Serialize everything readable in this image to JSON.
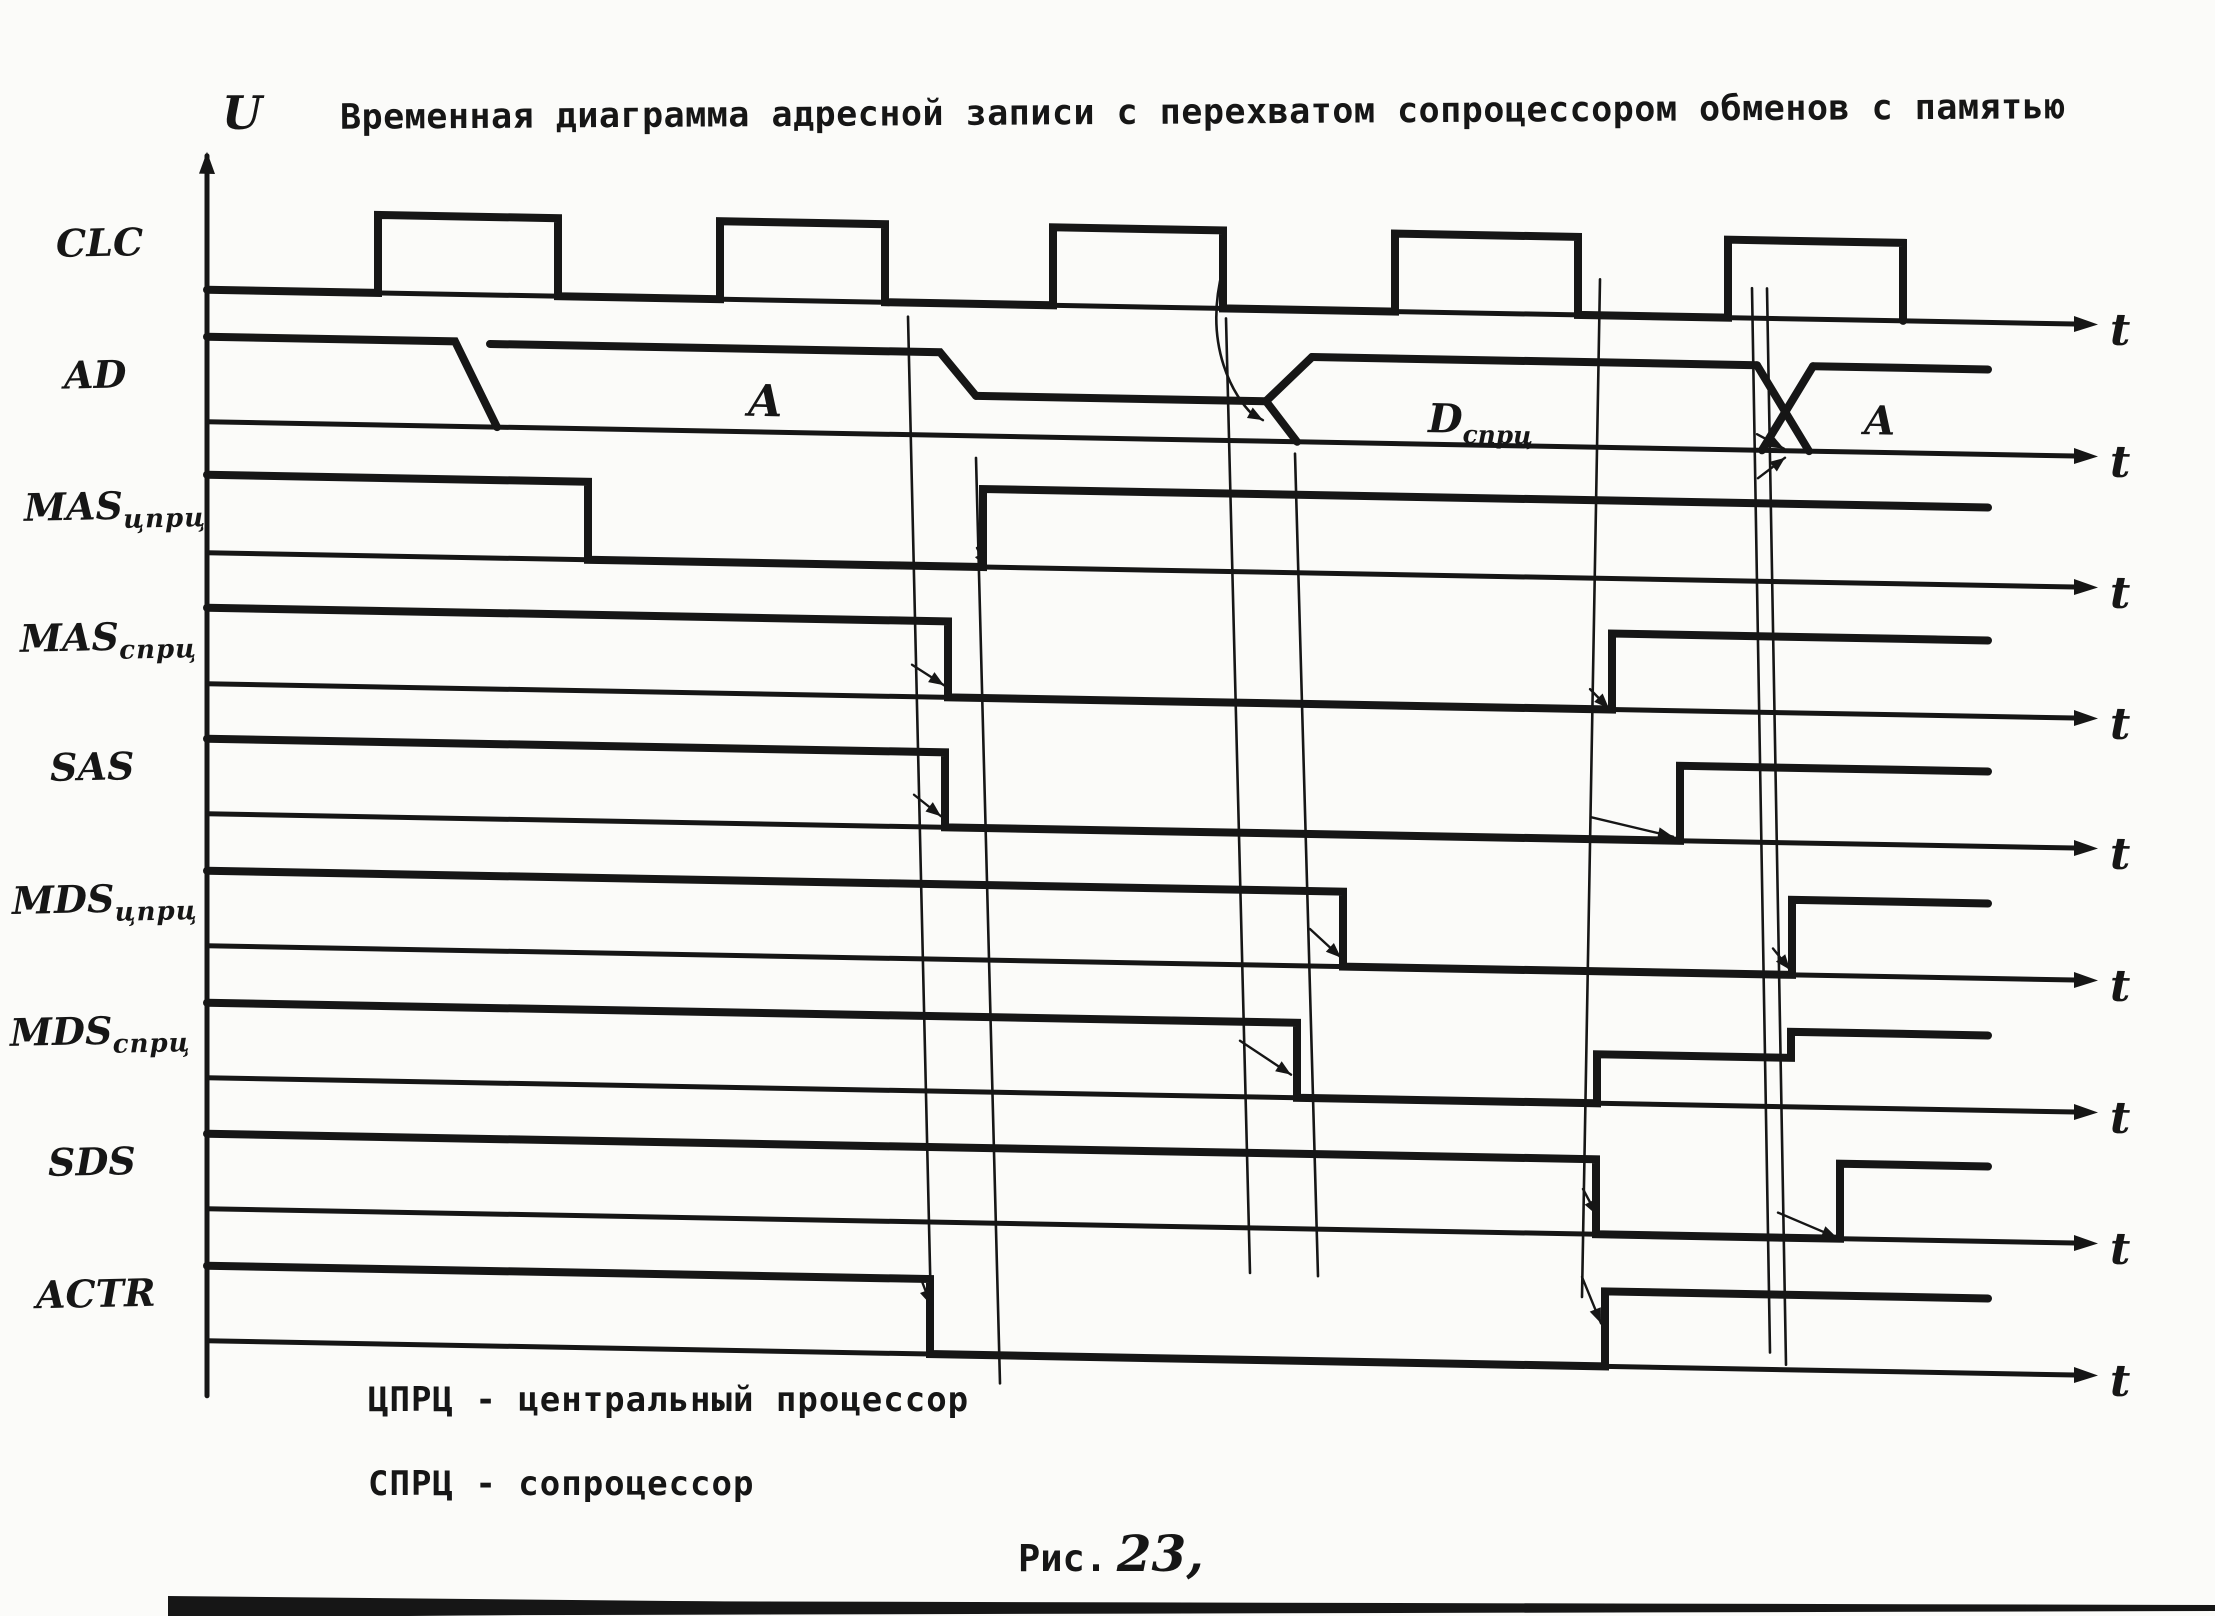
{
  "title": "Временная диаграмма адресной записи с перехватом сопроцессором обменов с памятью",
  "colors": {
    "ink": "#161616",
    "paper": "#fbfbf9"
  },
  "axis": {
    "u_label": "U",
    "t_label": "t",
    "x_start": 207,
    "x_axis_end": 2082,
    "wave_end": 1988,
    "skew_deg": 1.05,
    "u_axis_top": 152,
    "u_axis_bottom": 1392
  },
  "signals": [
    {
      "name": "CLC",
      "sub": "",
      "label_left": 56,
      "label_top": 220,
      "type": "clock",
      "base": 286,
      "high": 208,
      "pulses": [
        [
          378,
          558
        ],
        [
          720,
          885
        ],
        [
          1053,
          1223
        ],
        [
          1395,
          1578
        ],
        [
          1728,
          1903
        ]
      ]
    },
    {
      "name": "AD",
      "sub": "",
      "label_left": 64,
      "label_top": 352,
      "type": "bus",
      "base": 418,
      "polylines": [
        [
          [
            207,
            333
          ],
          [
            455,
            333
          ],
          [
            497,
            418
          ]
        ],
        [
          [
            490,
            335
          ],
          [
            940,
            335
          ],
          [
            976,
            378
          ]
        ],
        [
          [
            976,
            378
          ],
          [
            1266,
            378
          ]
        ],
        [
          [
            1266,
            378
          ],
          [
            1312,
            333
          ]
        ],
        [
          [
            1266,
            378
          ],
          [
            1297,
            418
          ]
        ],
        [
          [
            1312,
            333
          ],
          [
            1757,
            333
          ]
        ],
        [
          [
            1757,
            333
          ],
          [
            1809,
            418
          ]
        ],
        [
          [
            1762,
            418
          ],
          [
            1813,
            333
          ]
        ],
        [
          [
            1813,
            333
          ],
          [
            1988,
            333
          ]
        ]
      ],
      "bus_labels": [
        {
          "text": "A",
          "sub": "",
          "x": 748,
          "y": 402,
          "size": 44
        },
        {
          "text": "D",
          "sub": "спрц",
          "x": 1428,
          "y": 406,
          "size": 40
        },
        {
          "text": "A",
          "sub": "",
          "x": 1864,
          "y": 400,
          "size": 40
        }
      ]
    },
    {
      "name": "MAS",
      "sub": "цпрц",
      "label_left": 24,
      "label_top": 483,
      "type": "level",
      "base": 549,
      "high": 471,
      "steps": [
        [
          588,
          "L"
        ],
        [
          983,
          "H"
        ]
      ]
    },
    {
      "name": "MAS",
      "sub": "спрц",
      "label_left": 20,
      "label_top": 614,
      "type": "level",
      "base": 680,
      "high": 604,
      "steps": [
        [
          948,
          "L"
        ],
        [
          1612,
          "H"
        ]
      ]
    },
    {
      "name": "SAS",
      "sub": "",
      "label_left": 50,
      "label_top": 744,
      "type": "level",
      "base": 810,
      "high": 735,
      "steps": [
        [
          945,
          "L"
        ],
        [
          1680,
          "H"
        ]
      ]
    },
    {
      "name": "MDS",
      "sub": "цпрц",
      "label_left": 12,
      "label_top": 876,
      "type": "level",
      "base": 942,
      "high": 867,
      "steps": [
        [
          1343,
          "L"
        ],
        [
          1792,
          "H"
        ]
      ]
    },
    {
      "name": "MDS",
      "sub": "спрц",
      "label_left": 10,
      "label_top": 1008,
      "type": "level",
      "base": 1074,
      "high": 999,
      "steps": [
        [
          1297,
          "L"
        ],
        [
          1597,
          "M"
        ],
        [
          1791,
          "H"
        ]
      ]
    },
    {
      "name": "SDS",
      "sub": "",
      "label_left": 48,
      "label_top": 1139,
      "type": "level",
      "base": 1205,
      "high": 1130,
      "steps": [
        [
          1596,
          "L"
        ],
        [
          1840,
          "H"
        ]
      ]
    },
    {
      "name": "ACTR",
      "sub": "",
      "label_left": 36,
      "label_top": 1271,
      "type": "level",
      "base": 1337,
      "high": 1262,
      "steps": [
        [
          930,
          "L"
        ],
        [
          1605,
          "H"
        ]
      ]
    }
  ],
  "causality": {
    "lines": [
      [
        [
          908,
          300
        ],
        [
          932,
          1337
        ]
      ],
      [
        [
          976,
          440
        ],
        [
          1000,
          1365
        ]
      ],
      [
        [
          1226,
          296
        ],
        [
          1250,
          1250
        ]
      ],
      [
        [
          1295,
          430
        ],
        [
          1318,
          1252
        ]
      ],
      [
        [
          1600,
          250
        ],
        [
          1582,
          1268
        ]
      ],
      [
        [
          1752,
          256
        ],
        [
          1770,
          1320
        ]
      ],
      [
        [
          1767,
          256
        ],
        [
          1786,
          1332
        ]
      ]
    ],
    "curves": [
      "M1223,246 C1202,326 1236,376 1252,391"
    ],
    "arrows": [
      [
        [
          912,
          648
        ],
        [
          944,
          668
        ]
      ],
      [
        [
          914,
          778
        ],
        [
          941,
          799
        ]
      ],
      [
        [
          921,
          1262
        ],
        [
          931,
          1288
        ]
      ],
      [
        [
          977,
          530
        ],
        [
          987,
          550
        ]
      ],
      [
        [
          1240,
          1018
        ],
        [
          1291,
          1051
        ]
      ],
      [
        [
          1310,
          905
        ],
        [
          1341,
          933
        ]
      ],
      [
        [
          1590,
          660
        ],
        [
          1609,
          679
        ]
      ],
      [
        [
          1591,
          788
        ],
        [
          1673,
          806
        ]
      ],
      [
        [
          1583,
          1160
        ],
        [
          1597,
          1186
        ]
      ],
      [
        [
          1757,
          402
        ],
        [
          1784,
          416
        ]
      ],
      [
        [
          1758,
          446
        ],
        [
          1785,
          425
        ]
      ],
      [
        [
          1773,
          916
        ],
        [
          1790,
          937
        ]
      ],
      [
        [
          1778,
          1180
        ],
        [
          1837,
          1204
        ]
      ],
      [
        [
          1582,
          1248
        ],
        [
          1601,
          1294
        ]
      ],
      [
        [
          1252,
          391
        ],
        [
          1263,
          397
        ]
      ]
    ]
  },
  "scan_strip": {
    "d1": "M168,1600 L2215,1605 L2215,1611 L168,1616 Z",
    "d2": "M168,1596 L770,1602 L770,1613 L168,1618 Z"
  },
  "legend_lines": [
    "ЦПРЦ - центральный процессор",
    "СПРЦ - сопроцессор"
  ],
  "caption": {
    "prefix": "Рис.",
    "number": "23,"
  }
}
